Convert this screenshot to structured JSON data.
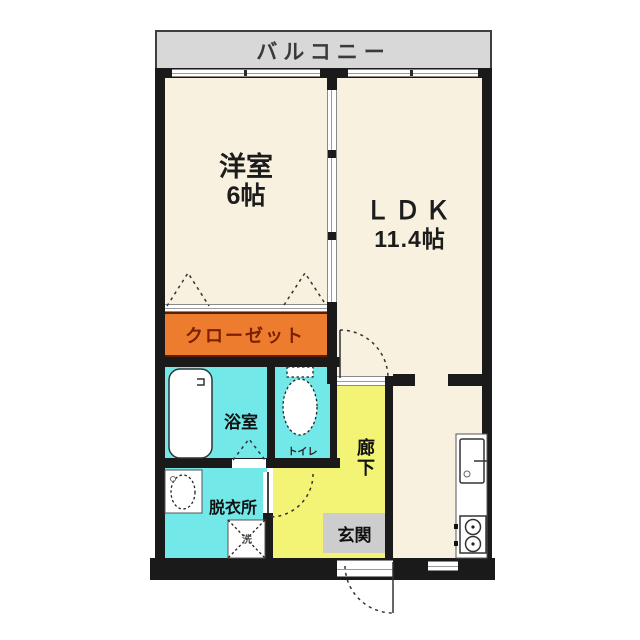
{
  "plan_title": "1LDK apartment floor plan",
  "balcony": {
    "label": "バルコニー"
  },
  "rooms": {
    "western_room": {
      "label": "洋室",
      "size": "6帖"
    },
    "ldk": {
      "label": "ＬＤＫ",
      "size": "11.4帖"
    },
    "closet": {
      "label": "クローゼット"
    },
    "bathroom": {
      "label": "浴室"
    },
    "toilet": {
      "label": "トイレ"
    },
    "dressing_room": {
      "label": "脱衣所"
    },
    "laundry_pan": {
      "label": "洗"
    },
    "corridor": {
      "label": "廊下"
    },
    "entrance": {
      "label": "玄関"
    }
  },
  "colors": {
    "room_cream": "#f8f1e0",
    "wet_area_cyan": "#72e8e8",
    "corridor_yellow": "#f3f376",
    "closet_orange": "#ee7c2f",
    "closet_text": "#7a2000",
    "balcony_gray": "#d8d8d8",
    "entrance_gray": "#cdcdcd",
    "wall_black": "#1a1a1a"
  },
  "icons": [
    "bathtub-icon",
    "toilet-icon",
    "washbasin-icon",
    "washing-machine-pan-icon",
    "kitchen-sink-icon",
    "stove-icon",
    "door-swing-arc",
    "folding-door-triangle"
  ]
}
